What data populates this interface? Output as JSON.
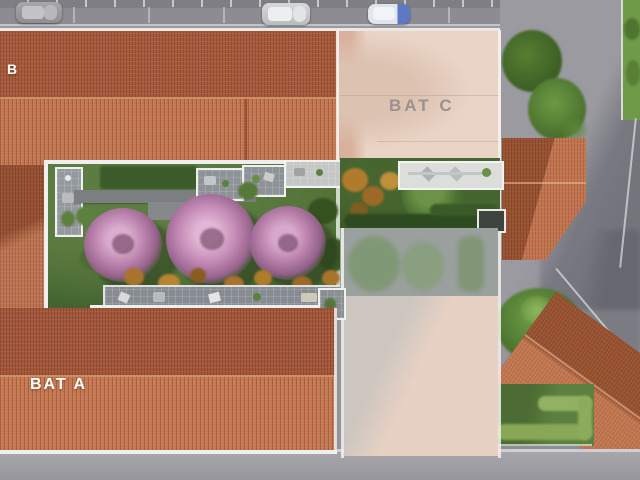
{
  "scene_title": "Residential site plan aerial render",
  "labels": {
    "bat_a": "BAT A",
    "bat_b": "B",
    "bat_c": "BAT C"
  },
  "buildings": [
    {
      "id": "bat-b",
      "label": "B",
      "state": "existing",
      "roof": "terracotta"
    },
    {
      "id": "bat-a",
      "label": "BAT A",
      "state": "existing",
      "roof": "terracotta"
    },
    {
      "id": "bat-c",
      "label": "BAT C",
      "state": "ghost-overlay",
      "roof": "faded-pink"
    }
  ],
  "environment": {
    "parking_cars": [
      {
        "position": "left",
        "color": "grey"
      },
      {
        "position": "center",
        "color": "silver-white"
      },
      {
        "position": "right",
        "color": "white-blue"
      }
    ],
    "garden": {
      "pink_trees": 3,
      "orange_shrubs": 7,
      "green_trees": 6,
      "terraces": "grey tiled strips with furniture",
      "paths": "grey concrete"
    }
  },
  "colors": {
    "roof_dark": "#a3573a",
    "roof_light": "#c3764f",
    "ghost_roof": "#e9d4c6",
    "lawn": "#4e6e38",
    "hedge_dark": "#2e4a20",
    "pink_tree": "#bd85af",
    "orange_shrub": "#a8742c",
    "road": "#93939a",
    "terrace": "#8e9399",
    "white_trim": "#eef0ee",
    "label_ghost_text": "#9b9190",
    "label_white_text": "#ffffff"
  }
}
